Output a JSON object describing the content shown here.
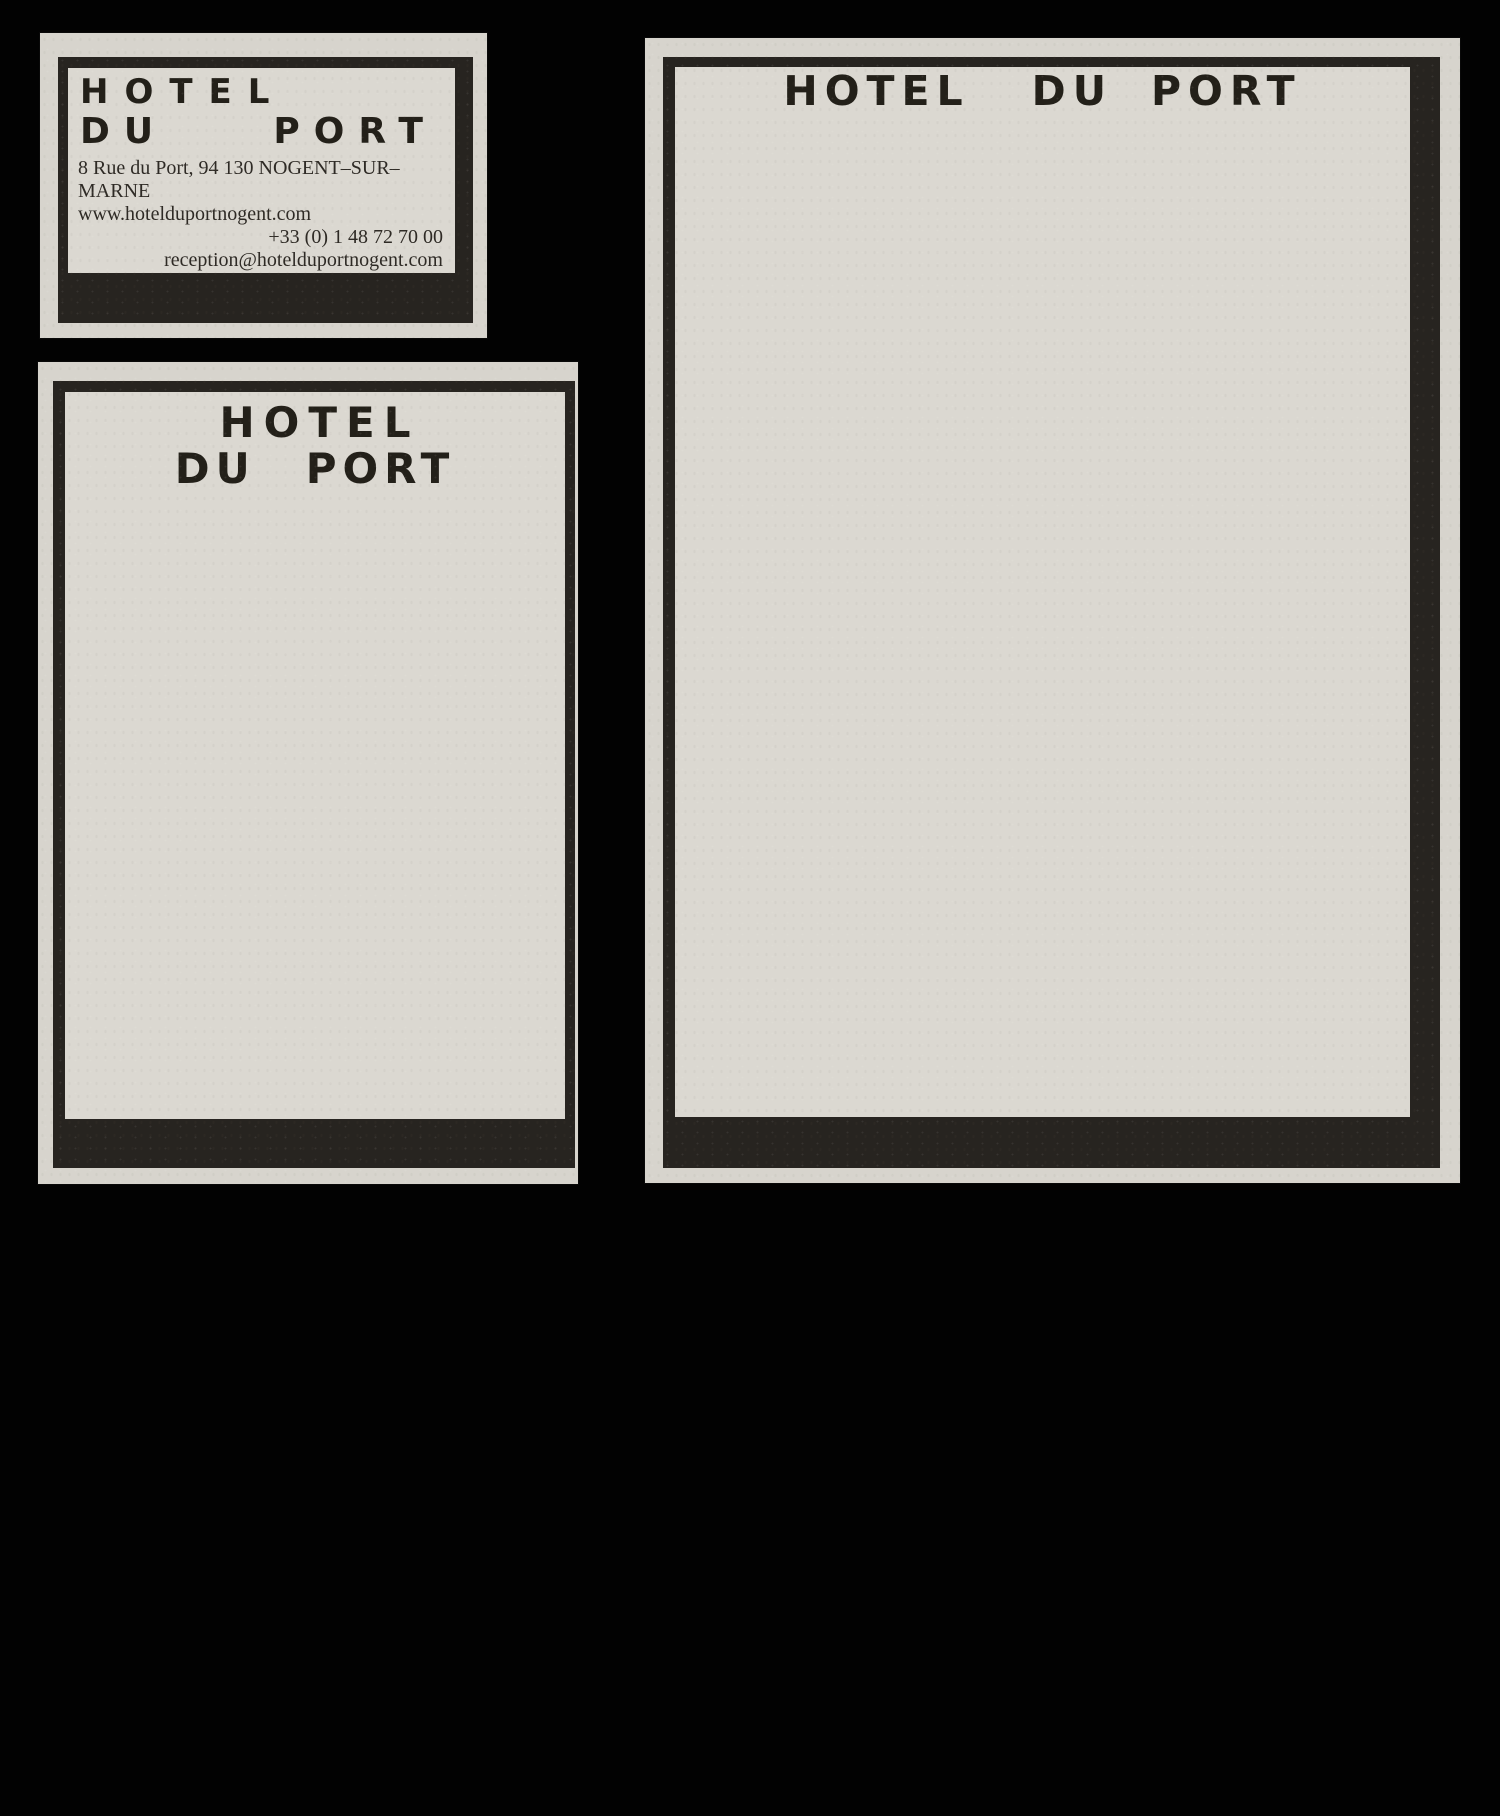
{
  "brand": {
    "hotel": "HOTEL",
    "du": "DU",
    "port": "PORT",
    "full_name": "HOTEL DU PORT"
  },
  "business_card": {
    "address": "8 Rue du Port, 94 130 NOGENT–SUR–MARNE",
    "website": "www.hotelduportnogent.com",
    "phone": "+33 (0) 1 48 72 70 00",
    "email": "reception@hotelduportnogent.com"
  },
  "colors": {
    "page_background": "#020202",
    "paper_edge": "#d7d4cd",
    "paper_panel": "#dbd8d1",
    "frame_black": "#272420",
    "logo_ink": "#232019",
    "text_ink": "#2e2a25"
  }
}
